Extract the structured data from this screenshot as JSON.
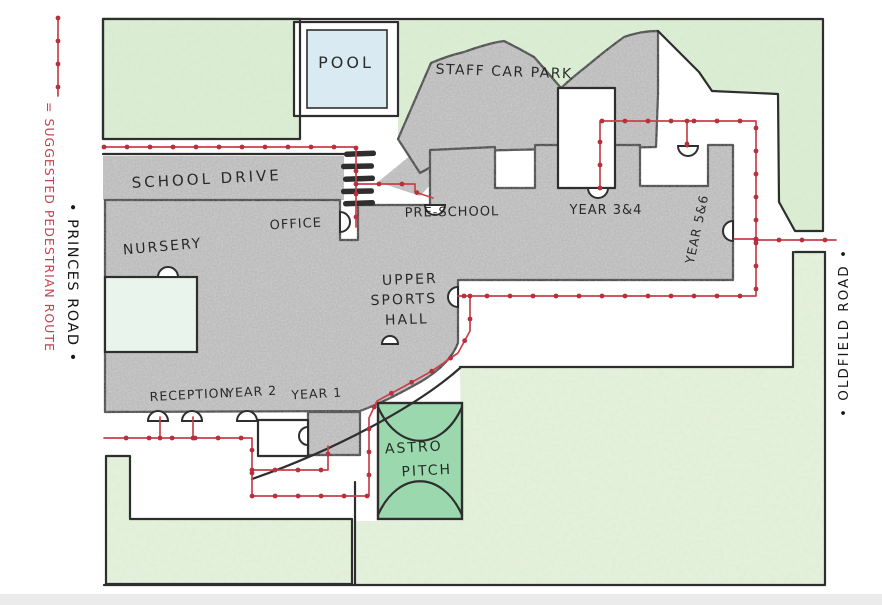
{
  "legend": {
    "sample_label": "= SUGGESTED PEDESTRIAN ROUTE",
    "color": "#c8414b"
  },
  "roads": {
    "left": "• PRINCES ROAD •",
    "right": "• OLDFIELD ROAD •"
  },
  "map": {
    "route_color": "#c8414b",
    "dot_color": "#b92f3b",
    "colors": {
      "grass": "#ddeed6",
      "grass_light": "#e6f2de",
      "pitch": "#9bd8ad",
      "pool": "#d9eaf2",
      "mint": "#e9f4ec",
      "pencil": "#cdcdcd",
      "outline": "#2e2e2e"
    },
    "labels": [
      {
        "id": "pool",
        "text": "POOL",
        "x": 346,
        "y": 68,
        "size": 16,
        "rot": 0,
        "ls": 3
      },
      {
        "id": "staff-car-park",
        "text": "STAFF CAR PARK",
        "x": 504,
        "y": 76,
        "size": 14,
        "rot": 2,
        "ls": 1.5
      },
      {
        "id": "school-drive",
        "text": "SCHOOL DRIVE",
        "x": 207,
        "y": 184,
        "size": 15,
        "rot": -3,
        "ls": 3
      },
      {
        "id": "office",
        "text": "OFFICE",
        "x": 296,
        "y": 228,
        "size": 13,
        "rot": -3,
        "ls": 1
      },
      {
        "id": "pre-school",
        "text": "PRE-SCHOOL",
        "x": 452,
        "y": 216,
        "size": 13,
        "rot": -1,
        "ls": 1
      },
      {
        "id": "year-3-4",
        "text": "YEAR 3&4",
        "x": 606,
        "y": 214,
        "size": 13,
        "rot": 0,
        "ls": 1
      },
      {
        "id": "year-5-6",
        "text": "YEAR 5&6",
        "x": 701,
        "y": 230,
        "size": 12.5,
        "rot": -78,
        "ls": 1
      },
      {
        "id": "nursery",
        "text": "NURSERY",
        "x": 163,
        "y": 251,
        "size": 14,
        "rot": -5,
        "ls": 2
      },
      {
        "id": "upper",
        "text": "UPPER",
        "x": 410,
        "y": 284,
        "size": 14,
        "rot": -2,
        "ls": 2
      },
      {
        "id": "sports",
        "text": "SPORTS",
        "x": 404,
        "y": 304,
        "size": 14,
        "rot": -2,
        "ls": 2
      },
      {
        "id": "hall",
        "text": "HALL",
        "x": 407,
        "y": 324,
        "size": 14,
        "rot": -2,
        "ls": 2
      },
      {
        "id": "reception",
        "text": "RECEPTION",
        "x": 190,
        "y": 399,
        "size": 12.5,
        "rot": -3,
        "ls": 1
      },
      {
        "id": "year-2",
        "text": "YEAR 2",
        "x": 252,
        "y": 396,
        "size": 12.5,
        "rot": -3,
        "ls": 1
      },
      {
        "id": "year-1",
        "text": "YEAR 1",
        "x": 317,
        "y": 398,
        "size": 12.5,
        "rot": -3,
        "ls": 1
      },
      {
        "id": "astro",
        "text": "ASTRO",
        "x": 414,
        "y": 452,
        "size": 14,
        "rot": -3,
        "ls": 2
      },
      {
        "id": "pitch",
        "text": "PITCH",
        "x": 427,
        "y": 475,
        "size": 14,
        "rot": -3,
        "ls": 2
      }
    ],
    "routes": [
      {
        "name": "legend-sample",
        "points": [
          [
            58,
            18
          ],
          [
            58,
            96
          ]
        ]
      },
      {
        "name": "school-drive-route",
        "points": [
          [
            104,
            147
          ],
          [
            356,
            147
          ],
          [
            356,
            227
          ]
        ]
      },
      {
        "name": "preschool-branch",
        "points": [
          [
            356,
            184
          ],
          [
            415,
            184
          ],
          [
            415,
            192
          ],
          [
            433,
            198
          ]
        ]
      },
      {
        "name": "north-east-route",
        "points": [
          [
            600,
            188
          ],
          [
            600,
            121
          ],
          [
            756,
            121
          ],
          [
            756,
            296
          ],
          [
            458,
            296
          ]
        ]
      },
      {
        "name": "notch-door-branch",
        "points": [
          [
            687,
            121
          ],
          [
            687,
            147
          ]
        ]
      },
      {
        "name": "east-door-branch",
        "points": [
          [
            756,
            239
          ],
          [
            734,
            239
          ]
        ]
      },
      {
        "name": "oldfield-exit-branch",
        "points": [
          [
            756,
            240
          ],
          [
            836,
            240
          ]
        ]
      },
      {
        "name": "south-route",
        "points": [
          [
            470,
            296
          ],
          [
            470,
            331
          ],
          [
            458,
            353
          ],
          [
            432,
            371
          ],
          [
            403,
            387
          ],
          [
            377,
            401
          ],
          [
            369,
            418
          ],
          [
            369,
            496
          ],
          [
            252,
            496
          ],
          [
            252,
            438
          ],
          [
            104,
            438
          ]
        ]
      },
      {
        "name": "reception-door-branch-1",
        "points": [
          [
            160,
            438
          ],
          [
            160,
            417
          ]
        ]
      },
      {
        "name": "reception-door-branch-2",
        "points": [
          [
            193,
            438
          ],
          [
            193,
            417
          ]
        ]
      },
      {
        "name": "year1-courtyard-branch",
        "points": [
          [
            252,
            470
          ],
          [
            328,
            470
          ],
          [
            328,
            446
          ]
        ]
      }
    ]
  }
}
